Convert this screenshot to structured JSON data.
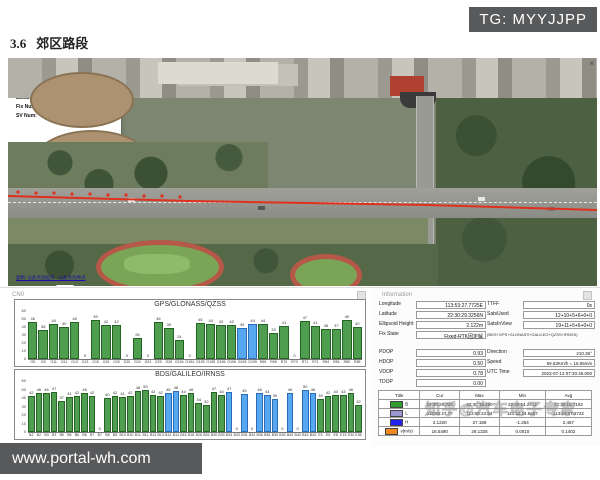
{
  "page": {
    "section_number": "3.6",
    "section_title": "郊区路段",
    "tg_badge": "TG: MYYJJPP",
    "site_watermark": "www.portal-wh.com",
    "overlay_watermark": "知乎@汽车电子专家"
  },
  "map_popup": {
    "title": "BASIC",
    "close": "×",
    "rows": [
      {
        "label": "UTC Time:",
        "value": "072046.000"
      },
      {
        "label": "Longitude:",
        "value": "113.69104791667"
      },
      {
        "label": "Latitude:",
        "value": "22.50814600000"
      },
      {
        "label": "Fix Num:",
        "value": "4"
      },
      {
        "label": "SV Num:",
        "value": "39"
      }
    ],
    "links": "复制: 以此点为起点 · 以此点为终点"
  },
  "cn0_panel": {
    "title": "CN0"
  },
  "info_panel": {
    "title": "Information",
    "fields_left": [
      {
        "label": "Longitude",
        "value": "113:53:27.7725E"
      },
      {
        "label": "Latitude",
        "value": "22:30:29.3256N"
      },
      {
        "label": "Ellipsoid Height",
        "value": "2.122m"
      },
      {
        "label": "Fix State",
        "value": "Fixed-RTK固定解"
      }
    ],
    "fields_right": [
      {
        "label": "TTFF",
        "value": "0s"
      },
      {
        "label": "SatsUsed",
        "value": "12+10+5+6+0+0"
      },
      {
        "label": "SatsInView",
        "value": "19+11+5+6+0+0"
      }
    ],
    "constellation_note": "(BDS+GPS+GLONASS+GALILEO+QZSS+IRNSS)",
    "dop_fields": [
      {
        "label": "PDOP",
        "value": "0.93"
      },
      {
        "label": "HDOP",
        "value": "0.50"
      },
      {
        "label": "VDOP",
        "value": "0.78"
      },
      {
        "label": "TDOP",
        "value": "0.00"
      }
    ],
    "nav_fields": [
      {
        "label": "Direction",
        "value": "210.36°"
      },
      {
        "label": "Speed",
        "value": "59.63Km/h = 16.55m/s"
      },
      {
        "label": "UTC Time",
        "value": "2023-07-13 07:20:46.000"
      }
    ],
    "table": {
      "headers": [
        "Title",
        "Cur",
        "Max",
        "Min",
        "Avg"
      ],
      "rows": [
        {
          "color": "#2f9e2f",
          "title": "B",
          "cur": "22:30:29.325",
          "max": "22:30:19.450",
          "min": "22:30:14.2412",
          "avg": "22:30:15.7192"
        },
        {
          "color": "#9a9ad0",
          "title": "L",
          "cur": "113:53:27.77",
          "max": "113:55:22.54",
          "min": "113:52:24.5657",
          "avg": "113:53:07.2722"
        },
        {
          "color": "#2222ee",
          "title": "H",
          "cur": "2.1220",
          "max": "27.159",
          "min": "-1.264",
          "avg": "2.467"
        },
        {
          "color": "#f08820",
          "title": "v(m/s)",
          "cur": "16.5490",
          "max": "29.1325",
          "min": "0.0010",
          "avg": "0.1402"
        }
      ]
    }
  },
  "chart_data": [
    {
      "type": "bar",
      "title": "GPS/GLONASS/QZSS",
      "ylabel": "CN0",
      "ylim": [
        0,
        60
      ],
      "yticks": [
        0,
        10,
        20,
        30,
        40,
        50,
        60
      ],
      "grid": false,
      "categories": [
        "G5",
        "G5",
        "G11",
        "G11",
        "G13",
        "G13",
        "G15",
        "G15",
        "G20",
        "G20",
        "G24",
        "G24",
        "G29",
        "G29",
        "G194",
        "G194",
        "G195",
        "G195",
        "G196",
        "G196",
        "G199",
        "G199",
        "R69",
        "R69",
        "R70",
        "R70",
        "R71",
        "R71",
        "R84",
        "R84",
        "R85",
        "R85"
      ],
      "values": [
        46,
        36,
        44,
        40,
        46,
        0,
        49,
        42,
        42,
        0,
        26,
        0,
        46,
        39,
        24,
        0,
        45,
        44,
        42,
        42,
        39,
        44,
        44,
        33,
        41,
        0,
        47,
        41,
        38,
        37,
        49,
        40
      ],
      "highlighted": [
        20,
        21
      ],
      "bar_color": "#4f9e4f",
      "bar_border": "#256325",
      "highlight_color": "#58a8f0",
      "highlight_border": "#2b6cb8"
    },
    {
      "type": "bar",
      "title": "BDS/GALILEO/IRNSS",
      "ylabel": "CN0",
      "ylim": [
        0,
        60
      ],
      "yticks": [
        0,
        10,
        20,
        30,
        40,
        50,
        60
      ],
      "grid": false,
      "categories": [
        "B2",
        "B2",
        "B3",
        "B3",
        "B5",
        "B5",
        "B6",
        "B6",
        "B7",
        "B7",
        "B8",
        "B8",
        "B10",
        "B10",
        "B11",
        "B11",
        "B13",
        "B13",
        "B14",
        "B14",
        "B16",
        "B16",
        "B26",
        "B26",
        "B30",
        "B30",
        "B33",
        "B33",
        "B34",
        "B34",
        "B36",
        "B36",
        "B39",
        "B39",
        "B40",
        "B40",
        "B43",
        "B43",
        "E3",
        "E5",
        "E8",
        "E15",
        "E34",
        "E36"
      ],
      "values": [
        42,
        46,
        46,
        47,
        37,
        41,
        42,
        46,
        42,
        0,
        40,
        42,
        41,
        42,
        48,
        50,
        43,
        42,
        46,
        48,
        44,
        46,
        34,
        32,
        47,
        44,
        47,
        0,
        45,
        0,
        46,
        44,
        39,
        0,
        46,
        0,
        50,
        46,
        39,
        42,
        43,
        43,
        46,
        32
      ],
      "highlighted": [
        18,
        19,
        26,
        28,
        30,
        31,
        32,
        34,
        36,
        37
      ],
      "bar_color": "#4f9e4f",
      "bar_border": "#256325",
      "highlight_color": "#58a8f0",
      "highlight_border": "#2b6cb8"
    }
  ]
}
